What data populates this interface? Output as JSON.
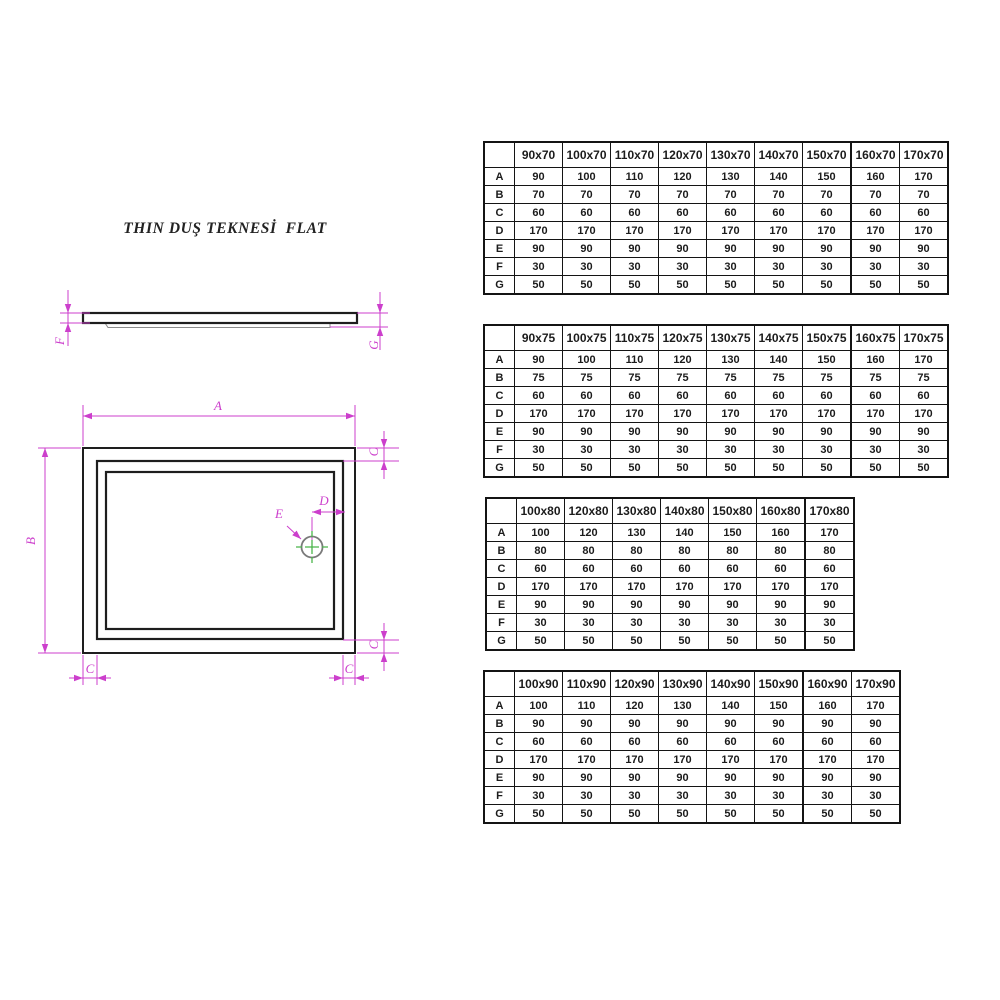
{
  "title": "THIN DUŞ TEKNESİ  FLAT",
  "drawing": {
    "labels": {
      "A": "A",
      "B": "B",
      "C": "C",
      "D": "D",
      "E": "E",
      "F": "F",
      "G": "G"
    },
    "colors": {
      "dimension": "#cc3fcc",
      "centermark": "#4ab54a",
      "line": "#1e1e1e"
    }
  },
  "tables": [
    {
      "name": "sizes-x70",
      "columns": [
        "90x70",
        "100x70",
        "110x70",
        "120x70",
        "130x70",
        "140x70",
        "150x70",
        "160x70",
        "170x70"
      ],
      "group_end": 7,
      "rows": [
        {
          "label": "A",
          "values": [
            "90",
            "100",
            "110",
            "120",
            "130",
            "140",
            "150",
            "160",
            "170"
          ]
        },
        {
          "label": "B",
          "values": [
            "70",
            "70",
            "70",
            "70",
            "70",
            "70",
            "70",
            "70",
            "70"
          ]
        },
        {
          "label": "C",
          "values": [
            "60",
            "60",
            "60",
            "60",
            "60",
            "60",
            "60",
            "60",
            "60"
          ]
        },
        {
          "label": "D",
          "values": [
            "170",
            "170",
            "170",
            "170",
            "170",
            "170",
            "170",
            "170",
            "170"
          ]
        },
        {
          "label": "E",
          "values": [
            "90",
            "90",
            "90",
            "90",
            "90",
            "90",
            "90",
            "90",
            "90"
          ]
        },
        {
          "label": "F",
          "values": [
            "30",
            "30",
            "30",
            "30",
            "30",
            "30",
            "30",
            "30",
            "30"
          ]
        },
        {
          "label": "G",
          "values": [
            "50",
            "50",
            "50",
            "50",
            "50",
            "50",
            "50",
            "50",
            "50"
          ]
        }
      ]
    },
    {
      "name": "sizes-x75",
      "columns": [
        "90x75",
        "100x75",
        "110x75",
        "120x75",
        "130x75",
        "140x75",
        "150x75",
        "160x75",
        "170x75"
      ],
      "group_end": 7,
      "rows": [
        {
          "label": "A",
          "values": [
            "90",
            "100",
            "110",
            "120",
            "130",
            "140",
            "150",
            "160",
            "170"
          ]
        },
        {
          "label": "B",
          "values": [
            "75",
            "75",
            "75",
            "75",
            "75",
            "75",
            "75",
            "75",
            "75"
          ]
        },
        {
          "label": "C",
          "values": [
            "60",
            "60",
            "60",
            "60",
            "60",
            "60",
            "60",
            "60",
            "60"
          ]
        },
        {
          "label": "D",
          "values": [
            "170",
            "170",
            "170",
            "170",
            "170",
            "170",
            "170",
            "170",
            "170"
          ]
        },
        {
          "label": "E",
          "values": [
            "90",
            "90",
            "90",
            "90",
            "90",
            "90",
            "90",
            "90",
            "90"
          ]
        },
        {
          "label": "F",
          "values": [
            "30",
            "30",
            "30",
            "30",
            "30",
            "30",
            "30",
            "30",
            "30"
          ]
        },
        {
          "label": "G",
          "values": [
            "50",
            "50",
            "50",
            "50",
            "50",
            "50",
            "50",
            "50",
            "50"
          ]
        }
      ]
    },
    {
      "name": "sizes-x80",
      "columns": [
        "100x80",
        "120x80",
        "130x80",
        "140x80",
        "150x80",
        "160x80",
        "170x80"
      ],
      "group_end": 6,
      "rows": [
        {
          "label": "A",
          "values": [
            "100",
            "120",
            "130",
            "140",
            "150",
            "160",
            "170"
          ]
        },
        {
          "label": "B",
          "values": [
            "80",
            "80",
            "80",
            "80",
            "80",
            "80",
            "80"
          ]
        },
        {
          "label": "C",
          "values": [
            "60",
            "60",
            "60",
            "60",
            "60",
            "60",
            "60"
          ]
        },
        {
          "label": "D",
          "values": [
            "170",
            "170",
            "170",
            "170",
            "170",
            "170",
            "170"
          ]
        },
        {
          "label": "E",
          "values": [
            "90",
            "90",
            "90",
            "90",
            "90",
            "90",
            "90"
          ]
        },
        {
          "label": "F",
          "values": [
            "30",
            "30",
            "30",
            "30",
            "30",
            "30",
            "30"
          ]
        },
        {
          "label": "G",
          "values": [
            "50",
            "50",
            "50",
            "50",
            "50",
            "50",
            "50"
          ]
        }
      ]
    },
    {
      "name": "sizes-x90",
      "columns": [
        "100x90",
        "110x90",
        "120x90",
        "130x90",
        "140x90",
        "150x90",
        "160x90",
        "170x90"
      ],
      "group_end": 6,
      "rows": [
        {
          "label": "A",
          "values": [
            "100",
            "110",
            "120",
            "130",
            "140",
            "150",
            "160",
            "170"
          ]
        },
        {
          "label": "B",
          "values": [
            "90",
            "90",
            "90",
            "90",
            "90",
            "90",
            "90",
            "90"
          ]
        },
        {
          "label": "C",
          "values": [
            "60",
            "60",
            "60",
            "60",
            "60",
            "60",
            "60",
            "60"
          ]
        },
        {
          "label": "D",
          "values": [
            "170",
            "170",
            "170",
            "170",
            "170",
            "170",
            "170",
            "170"
          ]
        },
        {
          "label": "E",
          "values": [
            "90",
            "90",
            "90",
            "90",
            "90",
            "90",
            "90",
            "90"
          ]
        },
        {
          "label": "F",
          "values": [
            "30",
            "30",
            "30",
            "30",
            "30",
            "30",
            "30",
            "30"
          ]
        },
        {
          "label": "G",
          "values": [
            "50",
            "50",
            "50",
            "50",
            "50",
            "50",
            "50",
            "50"
          ]
        }
      ]
    }
  ]
}
